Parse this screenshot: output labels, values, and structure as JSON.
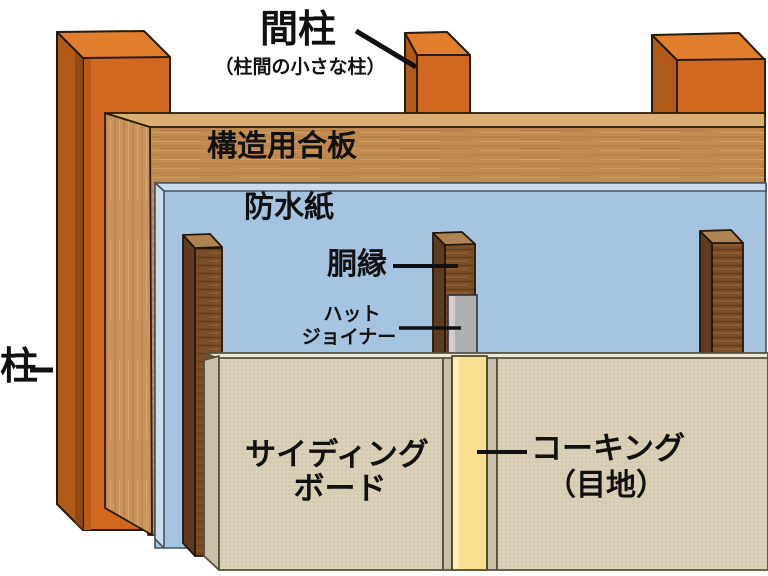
{
  "diagram": {
    "type": "wall-construction-cutaway",
    "background_color": "#FFFFFF",
    "annotation_color": "#111111",
    "labels": {
      "pillar": "柱",
      "stud": "間柱",
      "stud_note": "（柱間の小さな柱）",
      "structural_plywood": "構造用合板",
      "waterproof_paper": "防水紙",
      "furring_strip": "胴縁",
      "hat_joiner_line1": "ハット",
      "hat_joiner_line2": "ジョイナー",
      "siding_board_line1": "サイディング",
      "siding_board_line2": "ボード",
      "caulking_line1": "コーキング",
      "caulking_line2": "（目地）"
    },
    "colors": {
      "pillar_front": "#D0691F",
      "pillar_top": "#E07E2E",
      "pillar_side": "#B05A18",
      "pillar_side_dark": "#8A4511",
      "plywood_front": "#C28B50",
      "plywood_top": "#DCAE74",
      "plywood_side": "#C9935B",
      "waterproof_front": "#A6C3DF",
      "waterproof_edge": "#C9DCEE",
      "furring_front": "#7C4E28",
      "furring_top": "#B08354",
      "hat_joiner": "#AFAFAF",
      "hat_joiner_highlight": "#CFCFCF",
      "siding_front": "#DCD3BC",
      "siding_top": "#EFE8D6",
      "siding_edge": "#C9BFA6",
      "caulking": "#F7E08F",
      "outline": "#2A1A08"
    }
  }
}
